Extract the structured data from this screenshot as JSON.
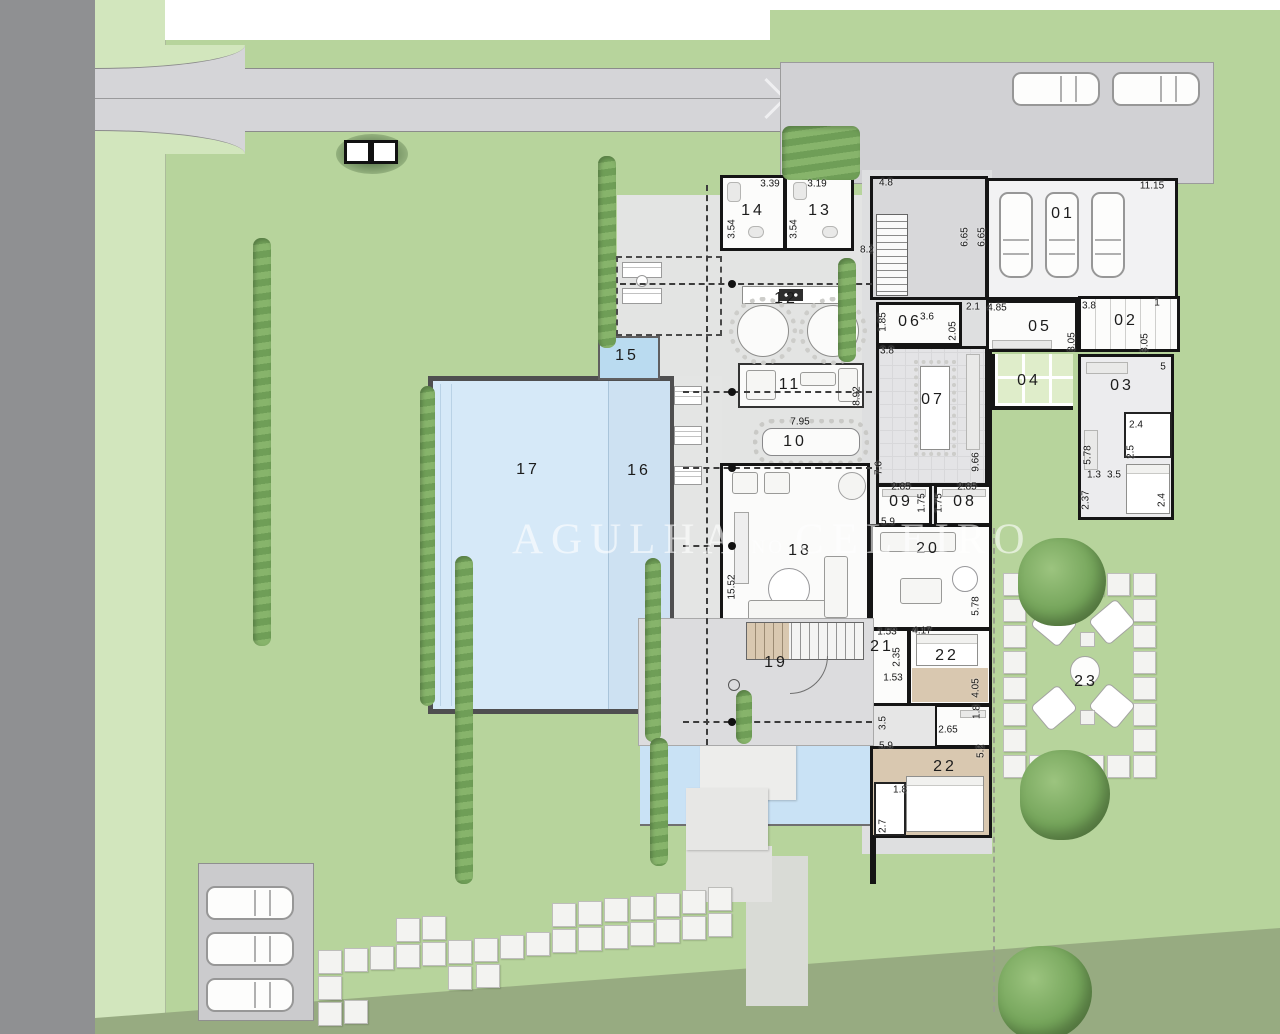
{
  "site_plan": {
    "watermark": {
      "word1": "AGULHA",
      "word2": "NO",
      "word3": "CELEIRO"
    },
    "room_labels": [
      {
        "label": "01",
        "x": 1063,
        "y": 214
      },
      {
        "label": "02",
        "x": 1126,
        "y": 321
      },
      {
        "label": "03",
        "x": 1122,
        "y": 386
      },
      {
        "label": "04",
        "x": 1029,
        "y": 381
      },
      {
        "label": "05",
        "x": 1040,
        "y": 327
      },
      {
        "label": "06",
        "x": 910,
        "y": 322
      },
      {
        "label": "07",
        "x": 933,
        "y": 400
      },
      {
        "label": "08",
        "x": 965,
        "y": 502
      },
      {
        "label": "09",
        "x": 901,
        "y": 502
      },
      {
        "label": "10",
        "x": 795,
        "y": 442
      },
      {
        "label": "11",
        "x": 790,
        "y": 385
      },
      {
        "label": "12",
        "x": 786,
        "y": 299
      },
      {
        "label": "13",
        "x": 820,
        "y": 211
      },
      {
        "label": "14",
        "x": 753,
        "y": 211
      },
      {
        "label": "15",
        "x": 627,
        "y": 356
      },
      {
        "label": "16",
        "x": 639,
        "y": 471
      },
      {
        "label": "17",
        "x": 528,
        "y": 470
      },
      {
        "label": "18",
        "x": 800,
        "y": 551
      },
      {
        "label": "19",
        "x": 776,
        "y": 663
      },
      {
        "label": "20",
        "x": 928,
        "y": 549
      },
      {
        "label": "21",
        "x": 882,
        "y": 647
      },
      {
        "label": "22",
        "x": 947,
        "y": 656
      },
      {
        "label": "22",
        "x": 945,
        "y": 767
      },
      {
        "label": "23",
        "x": 1086,
        "y": 682
      }
    ],
    "dimension_labels": [
      {
        "t": "3.39",
        "x": 770,
        "y": 184
      },
      {
        "t": "3.19",
        "x": 817,
        "y": 184
      },
      {
        "t": "4.8",
        "x": 886,
        "y": 183
      },
      {
        "t": "11.15",
        "x": 1152,
        "y": 186
      },
      {
        "t": "3.54",
        "x": 732,
        "y": 229,
        "v": true
      },
      {
        "t": "3.54",
        "x": 794,
        "y": 229,
        "v": true
      },
      {
        "t": "6.65",
        "x": 965,
        "y": 237,
        "v": true
      },
      {
        "t": "6.65",
        "x": 982,
        "y": 237,
        "v": true
      },
      {
        "t": "8.2",
        "x": 867,
        "y": 250
      },
      {
        "t": "1.85",
        "x": 883,
        "y": 322,
        "v": true
      },
      {
        "t": "3.6",
        "x": 927,
        "y": 317
      },
      {
        "t": "3.8",
        "x": 887,
        "y": 351
      },
      {
        "t": "2.05",
        "x": 953,
        "y": 331,
        "v": true
      },
      {
        "t": "2.1",
        "x": 973,
        "y": 307
      },
      {
        "t": "4.85",
        "x": 997,
        "y": 308
      },
      {
        "t": "3.8",
        "x": 1089,
        "y": 306
      },
      {
        "t": "1",
        "x": 1157,
        "y": 303
      },
      {
        "t": "3.05",
        "x": 1072,
        "y": 342,
        "v": true
      },
      {
        "t": "3.05",
        "x": 1145,
        "y": 343,
        "v": true
      },
      {
        "t": "5",
        "x": 1163,
        "y": 367
      },
      {
        "t": "2.4",
        "x": 1136,
        "y": 425
      },
      {
        "t": "2.5",
        "x": 1131,
        "y": 452,
        "v": true
      },
      {
        "t": "5.78",
        "x": 1088,
        "y": 455,
        "v": true
      },
      {
        "t": "1.3",
        "x": 1094,
        "y": 475
      },
      {
        "t": "3.5",
        "x": 1114,
        "y": 475
      },
      {
        "t": "2.37",
        "x": 1086,
        "y": 500,
        "v": true
      },
      {
        "t": "2.4",
        "x": 1162,
        "y": 500,
        "v": true
      },
      {
        "t": "9.66",
        "x": 976,
        "y": 462,
        "v": true
      },
      {
        "t": "7.6",
        "x": 879,
        "y": 468,
        "v": true
      },
      {
        "t": "8.92",
        "x": 857,
        "y": 396,
        "v": true
      },
      {
        "t": "7.95",
        "x": 800,
        "y": 422
      },
      {
        "t": "2.85",
        "x": 901,
        "y": 487
      },
      {
        "t": "2.85",
        "x": 967,
        "y": 487
      },
      {
        "t": "1.75",
        "x": 922,
        "y": 503,
        "v": true
      },
      {
        "t": "1.75",
        "x": 939,
        "y": 503,
        "v": true
      },
      {
        "t": "5.9",
        "x": 888,
        "y": 522
      },
      {
        "t": "15.52",
        "x": 732,
        "y": 587,
        "v": true
      },
      {
        "t": "5.78",
        "x": 976,
        "y": 606,
        "v": true
      },
      {
        "t": "1.53",
        "x": 887,
        "y": 632
      },
      {
        "t": "4.17",
        "x": 922,
        "y": 631
      },
      {
        "t": "2.35",
        "x": 897,
        "y": 657,
        "v": true
      },
      {
        "t": "1.53",
        "x": 893,
        "y": 678
      },
      {
        "t": "4.05",
        "x": 976,
        "y": 688,
        "v": true
      },
      {
        "t": "1.8",
        "x": 977,
        "y": 712,
        "v": true
      },
      {
        "t": "2.65",
        "x": 948,
        "y": 730
      },
      {
        "t": "3.5",
        "x": 883,
        "y": 723,
        "v": true
      },
      {
        "t": "5.9",
        "x": 886,
        "y": 746
      },
      {
        "t": "5.2",
        "x": 981,
        "y": 751,
        "v": true
      },
      {
        "t": "1.8",
        "x": 900,
        "y": 790
      },
      {
        "t": "2.7",
        "x": 883,
        "y": 826,
        "v": true
      }
    ],
    "stepping_stones": {
      "path": [
        [
          318,
          950
        ],
        [
          344,
          948
        ],
        [
          318,
          976
        ],
        [
          318,
          1002
        ],
        [
          344,
          1000
        ],
        [
          370,
          946
        ],
        [
          396,
          918
        ],
        [
          396,
          944
        ],
        [
          422,
          916
        ],
        [
          422,
          942
        ],
        [
          448,
          940
        ],
        [
          448,
          966
        ],
        [
          474,
          938
        ],
        [
          476,
          964
        ],
        [
          500,
          935
        ],
        [
          526,
          932
        ],
        [
          552,
          929
        ],
        [
          552,
          903
        ],
        [
          578,
          901
        ],
        [
          578,
          927
        ],
        [
          604,
          898
        ],
        [
          604,
          925
        ],
        [
          630,
          896
        ],
        [
          630,
          922
        ],
        [
          656,
          893
        ],
        [
          656,
          919
        ],
        [
          682,
          890
        ],
        [
          682,
          916
        ],
        [
          708,
          887
        ],
        [
          708,
          913
        ]
      ],
      "patio_ring": [
        [
          1003,
          573
        ],
        [
          1003,
          599
        ],
        [
          1003,
          625
        ],
        [
          1003,
          651
        ],
        [
          1003,
          677
        ],
        [
          1003,
          703
        ],
        [
          1003,
          729
        ],
        [
          1003,
          755
        ],
        [
          1133,
          573
        ],
        [
          1133,
          599
        ],
        [
          1133,
          625
        ],
        [
          1133,
          651
        ],
        [
          1133,
          677
        ],
        [
          1133,
          703
        ],
        [
          1133,
          729
        ],
        [
          1133,
          755
        ],
        [
          1029,
          573
        ],
        [
          1055,
          573
        ],
        [
          1081,
          573
        ],
        [
          1107,
          573
        ],
        [
          1029,
          755
        ],
        [
          1055,
          755
        ],
        [
          1081,
          755
        ],
        [
          1107,
          755
        ],
        [
          1055,
          781
        ],
        [
          1081,
          781
        ]
      ]
    },
    "cars": [
      {
        "o": "h",
        "x": 1012,
        "y": 72
      },
      {
        "o": "h",
        "x": 1112,
        "y": 72
      },
      {
        "o": "v",
        "x": 999,
        "y": 192
      },
      {
        "o": "v",
        "x": 1045,
        "y": 192
      },
      {
        "o": "v",
        "x": 1091,
        "y": 192
      },
      {
        "o": "h",
        "x": 206,
        "y": 886
      },
      {
        "o": "h",
        "x": 206,
        "y": 932
      },
      {
        "o": "h",
        "x": 206,
        "y": 978
      }
    ],
    "trees": [
      [
        1018,
        538,
        88
      ],
      [
        1020,
        750,
        90
      ],
      [
        998,
        946,
        94
      ]
    ],
    "hedges": [
      [
        253,
        238,
        18,
        408
      ],
      [
        420,
        386,
        15,
        320
      ],
      [
        455,
        556,
        18,
        328
      ],
      [
        598,
        156,
        18,
        192
      ],
      [
        645,
        558,
        16,
        184
      ],
      [
        838,
        258,
        18,
        104
      ],
      [
        650,
        738,
        18,
        128
      ],
      [
        736,
        690,
        16,
        54
      ],
      [
        782,
        126,
        78,
        54
      ]
    ]
  }
}
